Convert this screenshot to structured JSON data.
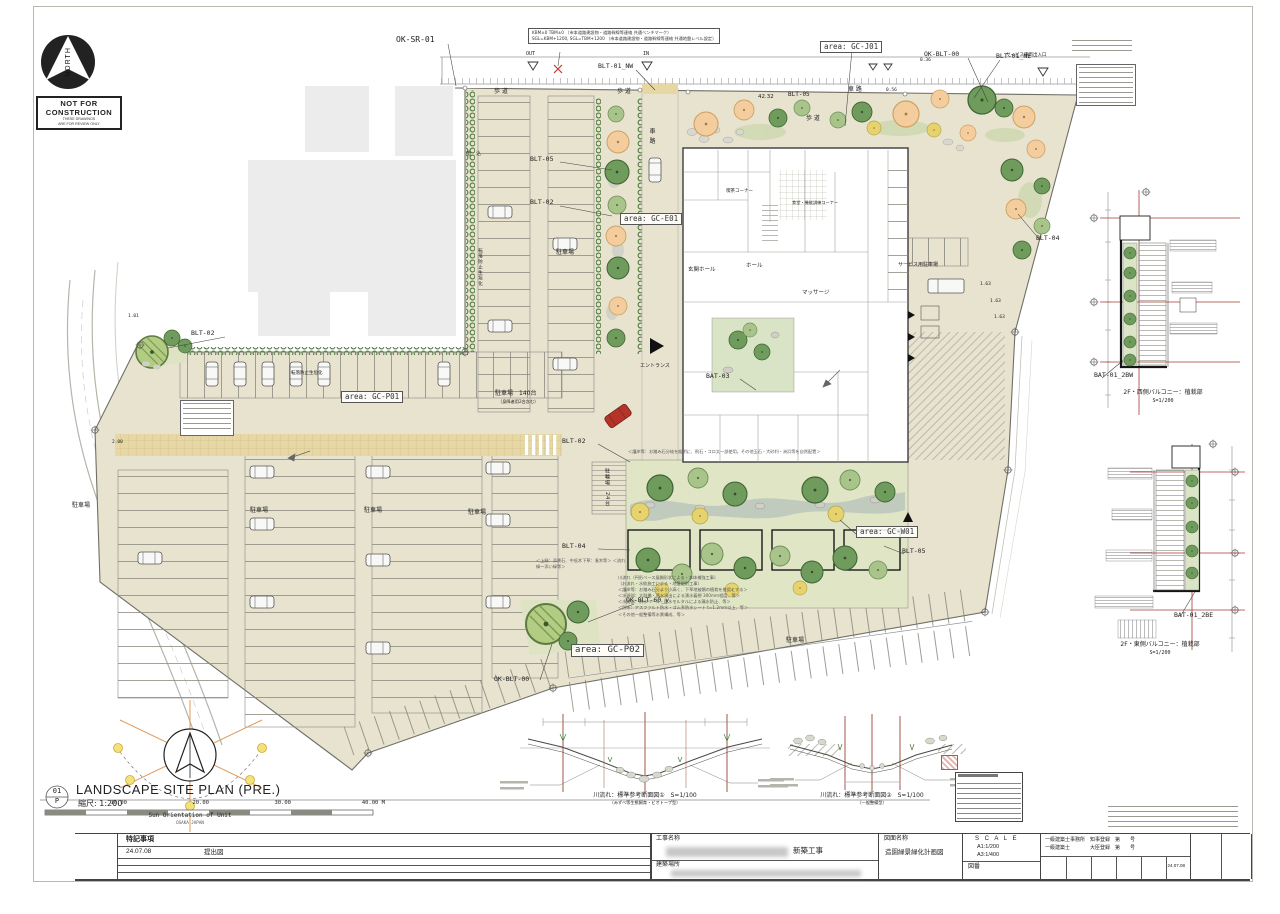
{
  "colors": {
    "site": "#e8e3cf",
    "paving": "#e6d7a4",
    "green_dark": "#6f9c5c",
    "green_light": "#a9c48b",
    "tree_peach": "#f3cd9e",
    "tree_yellow": "#e6d36f",
    "accent_red": "#b5342a",
    "guide_red": "#a83c30"
  },
  "stamp": {
    "north": "NORTH",
    "l1": "NOT FOR",
    "l2": "CONSTRUCTION",
    "l3": "THESE DRAWINGS",
    "l4": "ARE FOR REVIEW ONLY"
  },
  "notes": {
    "bm1": "KBM±0 TBM±0 （市本道路建設物・道路幹線等連絡 共通ベンチマーク）",
    "bm2": "SGL=KBM+1200, SGL=TBM+1200 （市本道路建設物・道路幹線等連絡 共通地盤レベル設定）",
    "service_gate": "サービス車両出入口"
  },
  "labels": {
    "ok_sr_01": "OK-SR-01",
    "blt_01_nw": "BLT-01_NW",
    "blt_01_ne": "BLT-01_NE",
    "ok_blt_00": "OK-BLT-00",
    "blt_05": "BLT-05",
    "blt_02": "BLT-02",
    "blt_04": "BLT-04",
    "bat_03": "BAT-03",
    "ok_blt_60": "OK-BLT-60_y",
    "bat_01_2bw": "BAT-01_2BW",
    "bat_01_2be": "BAT-01_2BE"
  },
  "areas": {
    "gc_j01": "area: GC-J01",
    "gc_e01": "area: GC-E01",
    "gc_p01": "area: GC-P01",
    "gc_p02": "area: GC-P02",
    "gc_w01": "area: GC-W01"
  },
  "plan": {
    "sidewalk": "歩 道",
    "roadway": "車 路",
    "parking": "駐車場",
    "parking_main": "駐車場　140台",
    "parking_sub": "（身障者用2台含む）",
    "bike_full": "駐輪場　24台",
    "hedge_note": "転落防止生垣化",
    "planting": "植　込",
    "entrance": "エントランス",
    "service_parking": "サービス用駐車場",
    "out": "OUT",
    "in": "IN"
  },
  "dims": {
    "d4232": "42.32",
    "d036": "0.36",
    "d056": "0.56",
    "d163": "1.63",
    "d101": "1.01",
    "d200": "2.00"
  },
  "rooms": {
    "genkan": "玄関ホール",
    "hall": "ホール",
    "massage": "マッサージ",
    "cafe": "喫茶コーナー",
    "dining": "食堂・機能訓練コーナー"
  },
  "garden_notes": {
    "top": "＜護岸等：お踏み石分岐を般明に、飛石・コロ太一部使用。その他玉石・大砂利・洲浜等を自然配置＞",
    "left1": "＜上緑：添景石、中低木下草：潅木等＞",
    "left2": "＜流れ緑〜添い緑等＞",
    "list": [
      "川流れ（円形ベース展開形状による・本体補強工事）",
      "（お流れ・水紋施工による・地盤掘削工事）",
      "＜護岸等：お踏み石分より小高く、下草地被類の植栽を推奨とする＞",
      "＜水源部：太鼓橋・落水演出による湧水着想 300mm程度、等＞",
      "＜水路部：防水ベース・防水モルタルによる漏水防止、等＞",
      "＜防水：アスファルト防水・ゴム系防水シート t=1.2mm以上、等＞",
      "＜その他一般整備等水景構成、等＞"
    ]
  },
  "details": {
    "d1_caption": "2F・西側バルコニー：植栽部",
    "d1_scale": "S=1/200",
    "d2_caption": "2F・東側バルコニー：植栽部",
    "d2_scale": "S=1/200"
  },
  "sections": {
    "s1_title": "川流れ：標準参考断面図①　S=1/100",
    "s1_sub": "（みずべ等生態飼育・ビオトープ型）",
    "s2_title": "川流れ：標準参考断面図②　S=1/100",
    "s2_sub": "（一般整備型）"
  },
  "footer": {
    "no": "01",
    "code": "P",
    "title": "LANDSCAPE SITE PLAN (PRE.)",
    "scale": "縮尺: 1:200",
    "bar": [
      "10.00",
      "20.00",
      "30.00",
      "40.00 M"
    ]
  },
  "sun": {
    "caption": "Sun Orientation of Unit",
    "sub": "OSAKA JAPAN"
  },
  "titleblock": {
    "notes_header": "特記事項",
    "rev_date": "24.07.08",
    "rev_text": "提出図",
    "project_label": "工事名称",
    "project_tail": "新築工事",
    "location_label": "建築場所",
    "drawing_label": "図面名称",
    "drawing_value": "造園緑景緑化計画図",
    "scale_label": "S C A L E",
    "scale_a1": "A1:1/200",
    "scale_a3": "A3:1/400",
    "number_label": "図番",
    "reg_line1": "一級建築士事務所　知事登録　第　　号",
    "reg_line2": "一級建築士　　　　大臣登録　第　　号",
    "date_small": "24.07.08"
  }
}
